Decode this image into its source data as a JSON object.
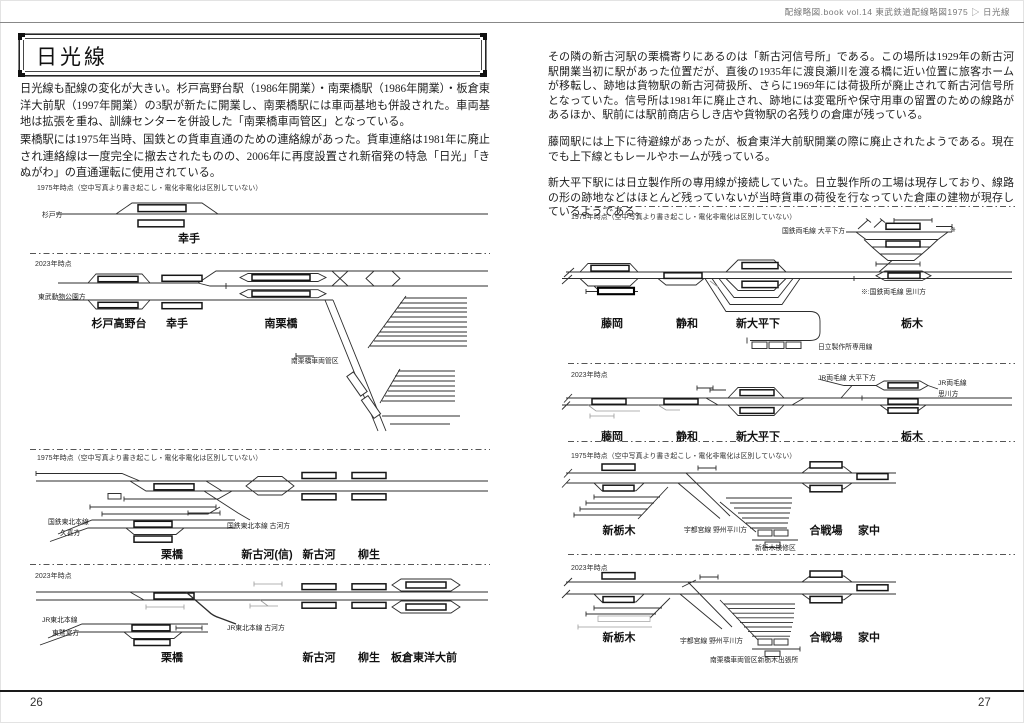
{
  "header": {
    "running_title": "配線略図.book vol.14 東武鉄道配線略図1975 ▷ 日光線"
  },
  "left_page": {
    "page_number": "26",
    "title": "日光線",
    "paragraphs": [
      "日光線も配線の変化が大きい。杉戸高野台駅（1986年開業）・南栗橋駅（1986年開業）・板倉東洋大前駅（1997年開業）の3駅が新たに開業し、南栗橋駅には車両基地も併設された。車両基地は拡張を重ね、訓練センターを併設した「南栗橋車両管区」となっている。",
      "栗橋駅には1975年当時、国鉄との貨車直通のための連絡線があった。貨車連絡は1981年に廃止され連絡線は一度完全に撤去されたものの、2006年に再度設置され新宿発の特急「日光」「きぬがわ」の直通運転に使用されている。"
    ],
    "d1": {
      "caption": "1975年時点（空中写真より書き起こし・電化非電化は区別していない）",
      "labels": {
        "sugito": "杉戸方"
      },
      "stations": [
        "幸手"
      ]
    },
    "d2": {
      "caption": "2023年時点",
      "labels": {
        "tobu_zoo": "東武動物公園方",
        "yard": "南栗橋車両管区"
      },
      "stations": [
        "杉戸高野台",
        "幸手",
        "南栗橋"
      ]
    },
    "d3": {
      "caption": "1975年時点（空中写真より書き起こし・電化非電化は区別していない）",
      "labels": {
        "jnr_line": "国鉄東北本線",
        "kuki": "久喜方",
        "koga": "国鉄東北本線 古河方"
      },
      "stations": [
        "栗橋",
        "新古河(信)",
        "新古河",
        "柳生"
      ]
    },
    "d4": {
      "caption": "2023年時点",
      "labels": {
        "jr_line": "JR東北本線",
        "washinomiya": "東鷲宮方",
        "koga": "JR東北本線 古河方"
      },
      "stations": [
        "栗橋",
        "新古河",
        "柳生",
        "板倉東洋大前"
      ]
    }
  },
  "right_page": {
    "page_number": "27",
    "paragraphs": [
      "その隣の新古河駅の栗橋寄りにあるのは「新古河信号所」である。この場所は1929年の新古河駅開業当初に駅があった位置だが、直後の1935年に渡良瀬川を渡る橋に近い位置に旅客ホームが移転し、跡地は貨物駅の新古河荷扱所、さらに1969年には荷扱所が廃止されて新古河信号所となっていた。信号所は1981年に廃止され、跡地には変電所や保守用車の留置のための線路があるほか、駅前には駅前商店らしき店や貨物駅の名残りの倉庫が残っている。",
      "藤岡駅には上下に待避線があったが、板倉東洋大前駅開業の際に廃止されたようである。現在でも上下線ともレールやホームが残っている。",
      "新大平下駅には日立製作所の専用線が接続していた。日立製作所の工場は現存しており、線路の形の跡地などはほとんど残っていないが当時貨車の荷役を行なっていた倉庫の建物が現存しているようである。"
    ],
    "r1": {
      "caption": "1975年時点（空中写真より書き起こし・電化非電化は区別していない）",
      "labels": {
        "ryomo": "国鉄両毛線 大平下方",
        "asterisk": "※",
        "note": "※:国鉄両毛線 思川方",
        "hitachi": "日立製作所専用線"
      },
      "stations": [
        "藤岡",
        "静和",
        "新大平下",
        "栃木"
      ]
    },
    "r2": {
      "caption": "2023年時点",
      "labels": {
        "ryomo": "JR両毛線 大平下方",
        "jr_ryomo": "JR両毛線",
        "omoigawa": "思川方"
      },
      "stations": [
        "藤岡",
        "静和",
        "新大平下",
        "栃木"
      ]
    },
    "r3": {
      "caption": "1975年時点（空中写真より書き起こし・電化非電化は区別していない）",
      "labels": {
        "utsunomiya": "宇都宮線 野州平川方",
        "yard": "新栃木検修区"
      },
      "stations": [
        "新栃木",
        "合戦場",
        "家中"
      ]
    },
    "r4": {
      "caption": "2023年時点",
      "labels": {
        "utsunomiya": "宇都宮線 野州平川方",
        "yard": "南栗橋車両管区新栃木出張所"
      },
      "stations": [
        "新栃木",
        "合戦場",
        "家中"
      ]
    }
  }
}
